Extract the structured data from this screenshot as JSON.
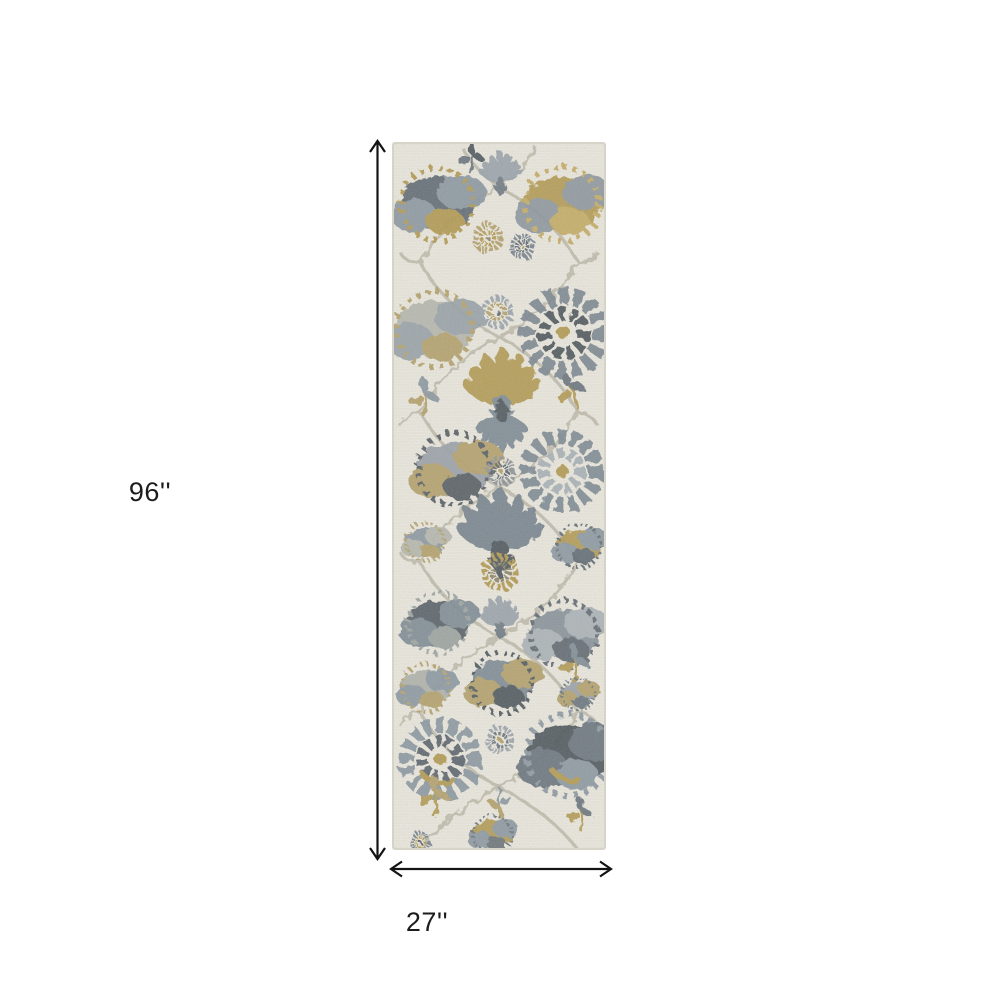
{
  "page": {
    "background_color": "#ffffff"
  },
  "diagram": {
    "kind": "product-dimension-diagram",
    "product_description": "Ivory, gray and gold distressed floral runner rug shown vertically with height and width dimension arrows",
    "height": {
      "label": "96''"
    },
    "width": {
      "label": "27''"
    },
    "colors": {
      "dimension_line": "#141414",
      "label_text": "#1c1c1c",
      "rug_base": "#e8e5db",
      "rug_gold": "#b1984f",
      "rug_tan": "#b3a06a",
      "rug_gray_blue": "#7e8b94",
      "rug_charcoal": "#4e565c",
      "rug_light_gray": "#b5b7ad",
      "rug_vine": "#bcb8a8"
    }
  }
}
